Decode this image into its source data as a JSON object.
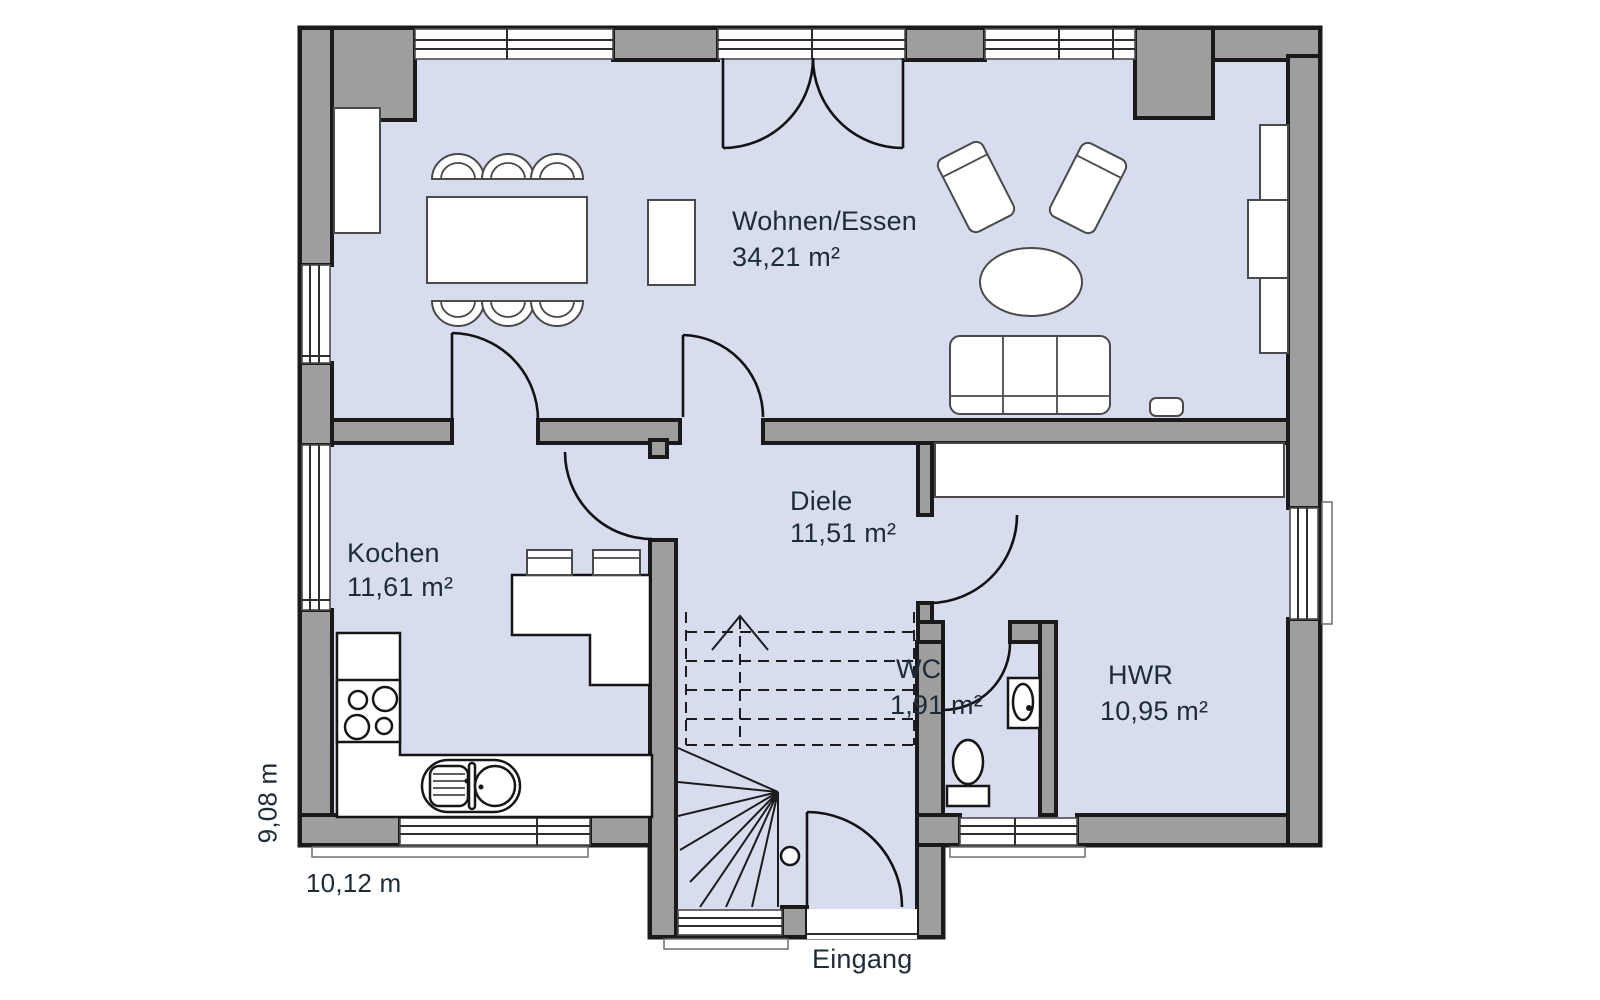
{
  "plan": {
    "rooms": [
      {
        "id": "wohnen-essen",
        "name": "Wohnen/Essen",
        "area": "34,21 m²"
      },
      {
        "id": "kochen",
        "name": "Kochen",
        "area": "11,61 m²"
      },
      {
        "id": "diele",
        "name": "Diele",
        "area": "11,51 m²"
      },
      {
        "id": "wc",
        "name": "WC",
        "area": "1,91 m²"
      },
      {
        "id": "hwr",
        "name": "HWR",
        "area": "10,95 m²"
      }
    ],
    "dimensions": {
      "width_label": "10,12 m",
      "depth_label": "9,08 m"
    },
    "entrance_label": "Eingang"
  },
  "colors": {
    "floor": "#d7dcee",
    "wall": "#9e9e9c",
    "outline": "#1a1a1a",
    "text": "#1d2c3a",
    "furniture_stroke": "#4a4a4a"
  },
  "furniture_icons": [
    "sideboard",
    "dining-table",
    "dining-chair",
    "cabinet",
    "armchair",
    "coffee-table",
    "sofa",
    "wall-shelf",
    "media-console",
    "kitchen-counter",
    "stove",
    "kitchen-sink",
    "kitchen-island",
    "bar-stool",
    "staircase",
    "built-in-closet",
    "wc-sink",
    "toilet"
  ]
}
